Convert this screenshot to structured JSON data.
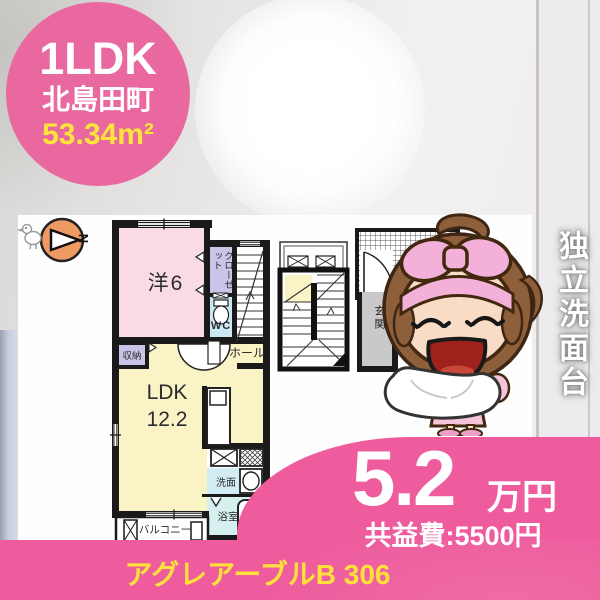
{
  "badge": {
    "layout": "1LDK",
    "location": "北島田町",
    "area": "53.34m²"
  },
  "compass": {
    "label": "N"
  },
  "floor_plan": {
    "western_room": "洋6",
    "closet": "クローゼット",
    "toilet": "WC",
    "hall": "ホール",
    "storage": "収納",
    "ldk_name": "LDK",
    "ldk_size": "12.2",
    "washroom": "洗面",
    "bathroom": "浴室",
    "balcony": "バルコニー",
    "entrance": "玄関"
  },
  "feature_banner": "独立洗面台",
  "price": {
    "rent": "5.2",
    "rent_unit": "万円",
    "common_fee": "共益費:5500円"
  },
  "footer": {
    "building": "アグレアーブルB 306"
  },
  "palette": {
    "brand_pink": "#ee5c9d",
    "badge_pink": "#e8689f",
    "text_yellow": "#ffe13a",
    "area_yellow": "#ffe43c",
    "room_pink": "#f9dbe7",
    "room_yellow": "#f9f3c6",
    "room_purple": "#c9c5e8",
    "room_cyan": "#cbe9f2"
  }
}
